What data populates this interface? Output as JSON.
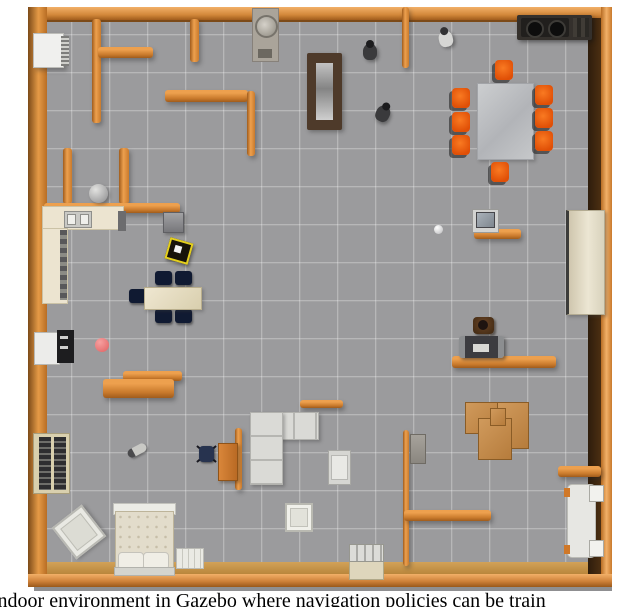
{
  "figure": {
    "caption_visible_text": "indoor environment in Gazebo where navigation policies can be train",
    "content": "Top-down view of an indoor environment simulated in Gazebo"
  },
  "scene": {
    "environment": "Gazebo indoor simulation (overhead view)",
    "objects": [
      "outer-wood-wall-frame",
      "interior-wall",
      "ac-unit",
      "washing-machine",
      "door-panel",
      "person-figure",
      "person-figure",
      "person-figure",
      "stove-cooktop",
      "conference-table",
      "orange-chair-x8",
      "trash-bin",
      "storage-cube",
      "mobile-robot",
      "kitchen-counter",
      "kitchen-sink",
      "dining-table",
      "navy-chair-x5",
      "red-ball",
      "refrigerator-unit",
      "orange-bench",
      "fallen-bottle",
      "office-chair",
      "wooden-desk",
      "l-shaped-couch",
      "side-table",
      "white-stool",
      "paper-stack",
      "cardboard-boxes",
      "gray-box",
      "coffee-maker",
      "printer",
      "computer-monitor",
      "white-ball",
      "tall-cabinet",
      "white-bench",
      "bookshelf",
      "tilted-seat",
      "bed",
      "dresser"
    ]
  },
  "colors": {
    "wall_wood": "#d9883c",
    "floor_gray": "#9b9b9d",
    "chair_orange": "#e8560e",
    "chair_navy": "#141e36",
    "table_beige": "#e7dfc9",
    "cardboard": "#c48e4f",
    "red_ball": "#ee7d7d",
    "caption_text": "#000000"
  }
}
